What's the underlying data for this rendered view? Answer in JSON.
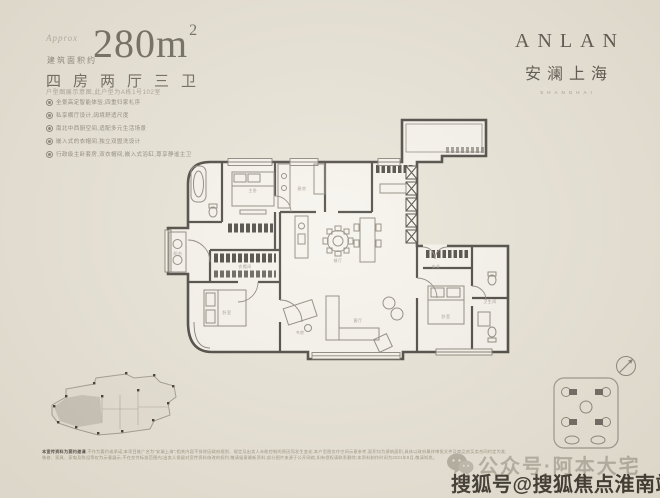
{
  "colors": {
    "bg": "#e8e3d6",
    "ink": "#5f5a50",
    "wall": "#45413b",
    "muted": "#9c968a",
    "watermark_dark": "#3b362e"
  },
  "title_block": {
    "approx_label": "Approx",
    "area_caption": "建筑面积约",
    "area_value": "280m",
    "area_exponent": "2",
    "layout_text": "四房两厅三卫",
    "note": "户型图展示意图,此户型为A栋1号102室",
    "features": [
      "全景高定智能体验,四重归家礼序",
      "私享横厅设计,阔境舒适尺度",
      "南北中西厨空间,适配多元生活场景",
      "嵌入式的衣帽间,独立双盥洗设计",
      "行政级主卧套房,双衣帽间,嵌入式浴缸,尊享静谧主卫"
    ]
  },
  "brand": {
    "en": "ANLAN",
    "cn": "安澜上海",
    "sub": "SHANGHAI"
  },
  "floorplan": {
    "rooms": [
      "主卧",
      "衣帽间",
      "厨房",
      "餐厅",
      "客厅",
      "卧室",
      "书房",
      "卧室",
      "卫生间",
      "阳台",
      "玄关"
    ],
    "icons": {
      "compass": "compass-icon"
    }
  },
  "watermarks": {
    "wechat_text": "公众号·阿本大宅",
    "sohu_text": "搜狐号@搜狐焦点淮南站",
    "icons": {
      "wechat": "wechat-icon"
    }
  },
  "disclaimer": {
    "line1_bold": "本宣传资料为要约邀请",
    "line1": ",不作为要约或承诺;本项目推广名为“安澜上海”;相关内容不排除因政府规划、规定及出卖人未能控制的原因而发生变化;本户型图仅作空间示意参考,面积均为建筑面积,具体以政府最终审批文件及商品房买卖合同约定为准;",
    "line2": "装修、家具、家电及陈设等仅为示意展示,不在交付标准范围内;出卖人保留对宣传资料修改的权利,敬请留意最新资料;部分图片来源于公开网络,如有侵权请联系删除;本资料制作时间为2021年8月,敬请知悉。"
  }
}
